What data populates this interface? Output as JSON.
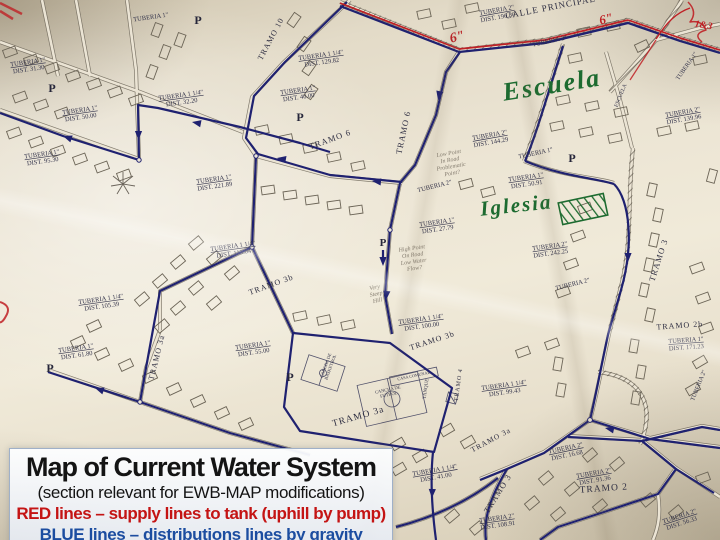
{
  "caption": {
    "title": "Map of Current Water System",
    "subtitle": "(section relevant for EWB-MAP modifications)",
    "legend_red": "RED lines – supply lines to tank (uphill by pump)",
    "legend_blue": "BLUE lines – distributions lines by gravity",
    "red_color": "#c41414",
    "blue_color": "#1c4da0"
  },
  "map": {
    "line_colors": {
      "supply": "#bf2025",
      "distribution": "#1f2170"
    },
    "labels": [
      {
        "t": "TUBERIA 1\"",
        "s": "DIST. 31.30",
        "x": 28,
        "y": 64,
        "r": -8
      },
      {
        "t": "TUBERIA 1\"",
        "x": 151,
        "y": 19,
        "r": -8
      },
      {
        "t": "P",
        "x": 198,
        "y": 24,
        "c": "pmark",
        "f": 12
      },
      {
        "t": "TUBERIA 1\"",
        "s": "DIST. 50.00",
        "x": 80,
        "y": 112,
        "r": -8
      },
      {
        "t": "TUBERIA 1\"",
        "s": "DIST. 95.30",
        "x": 42,
        "y": 156,
        "r": -8
      },
      {
        "t": "P",
        "x": 52,
        "y": 92,
        "c": "pmark",
        "f": 12
      },
      {
        "t": "TUBERIA 1 1/4\"",
        "s": "DIST. 32.20",
        "x": 181,
        "y": 97,
        "r": -8
      },
      {
        "t": "TRAMO 10",
        "x": 273,
        "y": 40,
        "r": -62,
        "c": "trm",
        "f": 8
      },
      {
        "t": "TUBERIA 1 1/4\"",
        "s": "DIST. 129.82",
        "x": 321,
        "y": 57,
        "r": -8
      },
      {
        "t": "TUBERIA 1\"",
        "s": "DIST. 40.00",
        "x": 298,
        "y": 92,
        "r": -8
      },
      {
        "t": "P",
        "x": 300,
        "y": 121,
        "c": "pmark",
        "f": 12
      },
      {
        "t": "TRAMO 6",
        "x": 331,
        "y": 142,
        "r": -20,
        "c": "trm",
        "f": 8.5
      },
      {
        "t": "TRAMO 6",
        "x": 406,
        "y": 133,
        "r": -78,
        "c": "trm",
        "f": 8.5
      },
      {
        "t": "TUBERIA 2\"",
        "s": "DIST. 190.80",
        "x": 497,
        "y": 12,
        "r": -10
      },
      {
        "t": "CALLE PRINCIPAL",
        "x": 551,
        "y": 10,
        "r": -11,
        "c": "trm",
        "f": 9
      },
      {
        "t": "TUBERIA 2\"",
        "x": 550,
        "y": 43,
        "r": -12
      },
      {
        "t": "ESCUELA",
        "x": 622,
        "y": 96,
        "r": -68,
        "f": 5.5
      },
      {
        "t": "TUBERIA 1\"",
        "x": 688,
        "y": 67,
        "r": -55,
        "f": 6
      },
      {
        "t": "TUBERIA 2\"",
        "s": "DIST. 139.96",
        "x": 683,
        "y": 114,
        "r": -10
      },
      {
        "t": "TUBERIA 2\"",
        "s": "DIST. 144.29",
        "x": 490,
        "y": 137,
        "r": -10
      },
      {
        "t": "TUBERIA 1\"",
        "x": 536,
        "y": 155,
        "r": -12
      },
      {
        "t": "P",
        "x": 572,
        "y": 162,
        "c": "pmark",
        "f": 12
      },
      {
        "t": "TUBERIA 1\"",
        "s": "DIST. 50.91",
        "x": 526,
        "y": 179,
        "r": -8
      },
      {
        "t": "Escuela",
        "x": 553,
        "y": 93,
        "r": -9,
        "c": "green",
        "f": 26
      },
      {
        "t": "Iglesia",
        "x": 517,
        "y": 212,
        "r": -6,
        "c": "green",
        "f": 21
      },
      {
        "t": "TUBERIA 2\"",
        "x": 435,
        "y": 188,
        "r": -14
      },
      {
        "t": "TUBERIA 1\"",
        "s": "DIST. 27.79",
        "x": 437,
        "y": 224,
        "r": -8
      },
      {
        "t": "P",
        "x": 383,
        "y": 246,
        "c": "pmark",
        "f": 11
      },
      {
        "t": "TUBERIA 1\"",
        "s": "DIST. 221.89",
        "x": 214,
        "y": 181,
        "r": -8
      },
      {
        "t": "TUBERIA 1 1/4\"",
        "s": "DIST. 113.04",
        "x": 233,
        "y": 248,
        "r": -8
      },
      {
        "t": "TUBERIA 1 1/4\"",
        "s": "DIST. 105.39",
        "x": 101,
        "y": 301,
        "r": -8
      },
      {
        "t": "TRAMO 3b",
        "x": 272,
        "y": 287,
        "r": -20,
        "c": "trm",
        "f": 8
      },
      {
        "t": "TUBERIA 2\"",
        "s": "DIST. 242.25",
        "x": 550,
        "y": 248,
        "r": -8
      },
      {
        "t": "TRAMO 3",
        "x": 661,
        "y": 261,
        "r": -72,
        "c": "trm",
        "f": 8.5
      },
      {
        "t": "TUBERIA 2\"",
        "x": 573,
        "y": 286,
        "r": -14
      },
      {
        "t": "TRAMO 2b",
        "x": 680,
        "y": 328,
        "r": -4,
        "c": "trm",
        "f": 8
      },
      {
        "t": "TUBERIA 1\"",
        "s": "DIST. 171.23",
        "x": 686,
        "y": 342,
        "r": -4
      },
      {
        "t": "TUBERIA 1\"",
        "s": "DIST. 61.80",
        "x": 76,
        "y": 350,
        "r": -8
      },
      {
        "t": "P",
        "x": 50,
        "y": 372,
        "c": "pmark",
        "f": 12
      },
      {
        "t": "TRAMO 3a",
        "x": 159,
        "y": 358,
        "r": -76,
        "c": "trm",
        "f": 8
      },
      {
        "t": "TUBERIA 1 1/4\"",
        "s": "DIST. 100.00",
        "x": 421,
        "y": 321,
        "r": -8
      },
      {
        "t": "TRAMO 3b",
        "x": 433,
        "y": 343,
        "r": -18,
        "c": "trm",
        "f": 8
      },
      {
        "t": "TUBERIA 1\"",
        "s": "DIST. 55.00",
        "x": 253,
        "y": 347,
        "r": -8
      },
      {
        "t": "P",
        "x": 290,
        "y": 381,
        "c": "pmark",
        "f": 12
      },
      {
        "l": [
          "CANCHA DE",
          "BASKETBOL"
        ],
        "x": 327,
        "y": 366,
        "r": -70,
        "f": 4.5
      },
      {
        "l": [
          "CANCHA DE",
          "FUTBOL"
        ],
        "x": 388,
        "y": 391,
        "r": -12,
        "f": 4.5
      },
      {
        "t": "CASA COMUNAL",
        "x": 414,
        "y": 377,
        "r": -12,
        "f": 4.2
      },
      {
        "t": "TANQUE",
        "x": 427,
        "y": 389,
        "r": -82,
        "f": 5
      },
      {
        "t": "TRAMO 4",
        "x": 460,
        "y": 385,
        "r": -82,
        "c": "trm",
        "f": 6
      },
      {
        "t": "TRAMO 3a",
        "x": 359,
        "y": 419,
        "r": -16,
        "c": "trm",
        "f": 9.5
      },
      {
        "t": "TUBERIA 1 1/4\"",
        "s": "DIST. 99.43",
        "x": 504,
        "y": 387,
        "r": -8
      },
      {
        "t": "TRAMO 3a",
        "x": 492,
        "y": 442,
        "r": -28,
        "c": "trm",
        "f": 7.5
      },
      {
        "t": "TUBERIA 2\"",
        "x": 700,
        "y": 386,
        "r": -68,
        "f": 6
      },
      {
        "t": "TUBERIA 2\"",
        "s": "DIST. 16.68",
        "x": 566,
        "y": 450,
        "r": -12
      },
      {
        "t": "TUBERIA 2\"",
        "s": "DIST. 91.36",
        "x": 594,
        "y": 475,
        "r": -10
      },
      {
        "t": "TRAMO 2",
        "x": 604,
        "y": 491,
        "r": -4,
        "c": "trm",
        "f": 9.5
      },
      {
        "t": "TRAMO 3",
        "x": 500,
        "y": 495,
        "r": -58,
        "c": "trm",
        "f": 8.5
      },
      {
        "t": "TUBERIA 2\"",
        "s": "DIST. 108.91",
        "x": 497,
        "y": 520,
        "r": -8
      },
      {
        "t": "TUBERIA 2\"",
        "s": "DIST. 56.33",
        "x": 680,
        "y": 518,
        "r": -18
      },
      {
        "t": "TUBERIA 1 1/4\"",
        "s": "DIST. 41.00",
        "x": 435,
        "y": 472,
        "r": -10
      },
      {
        "t": "6\"",
        "x": 458,
        "y": 41,
        "r": -14,
        "c": "redhand",
        "f": 14
      },
      {
        "t": "6\"",
        "x": 607,
        "y": 23,
        "r": -14,
        "c": "redhand",
        "f": 13
      },
      {
        "t": "1&3",
        "x": 703,
        "y": 28,
        "r": 10,
        "c": "redhand",
        "f": 10
      },
      {
        "l": [
          "Low Point",
          "In Road",
          "Problematic",
          "Point?"
        ],
        "x": 449,
        "y": 155,
        "r": -10,
        "c": "pencil",
        "f": 6
      },
      {
        "l": [
          "High Point",
          "On Road",
          "Low Water",
          "Flow?"
        ],
        "x": 412,
        "y": 250,
        "r": -8,
        "c": "pencil",
        "f": 6
      },
      {
        "l": [
          "Very",
          "Steep",
          "Hill"
        ],
        "x": 375,
        "y": 289,
        "r": -12,
        "c": "pencil",
        "f": 6
      }
    ]
  }
}
